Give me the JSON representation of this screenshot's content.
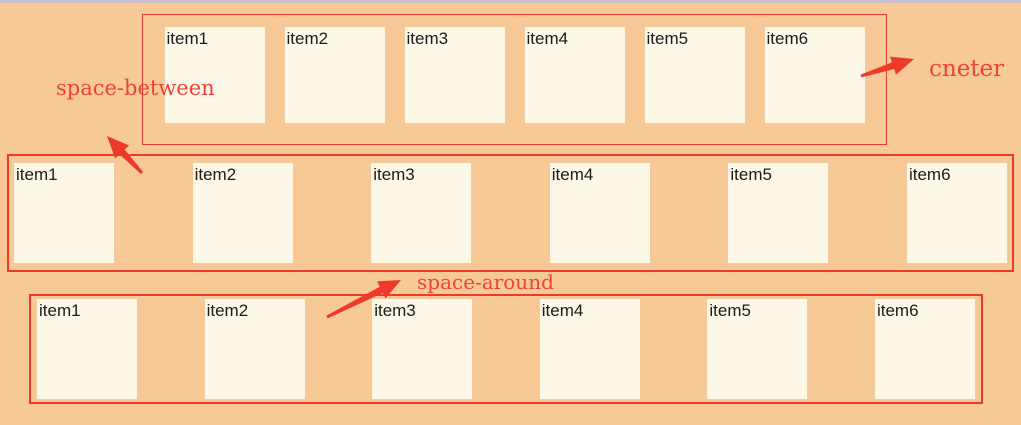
{
  "annotations": {
    "center": {
      "label": "cneter"
    },
    "space_between": {
      "label": "space-between"
    },
    "space_around": {
      "label": "space-around"
    }
  },
  "rows": [
    {
      "name": "center",
      "justify": "center",
      "items": [
        "item1",
        "item2",
        "item3",
        "item4",
        "item5",
        "item6"
      ]
    },
    {
      "name": "space-between",
      "justify": "space-between",
      "items": [
        "item1",
        "item2",
        "item3",
        "item4",
        "item5",
        "item6"
      ]
    },
    {
      "name": "space-around",
      "justify": "space-around",
      "items": [
        "item1",
        "item2",
        "item3",
        "item4",
        "item5",
        "item6"
      ]
    }
  ],
  "colors": {
    "background": "#f6c996",
    "window_top_edge": "#c4c1c5",
    "container_border_red": "#ee3a2b",
    "annotation_red": "#ee4437",
    "item_background": "#fcf7e6",
    "item_text": "#1b1b1b"
  }
}
